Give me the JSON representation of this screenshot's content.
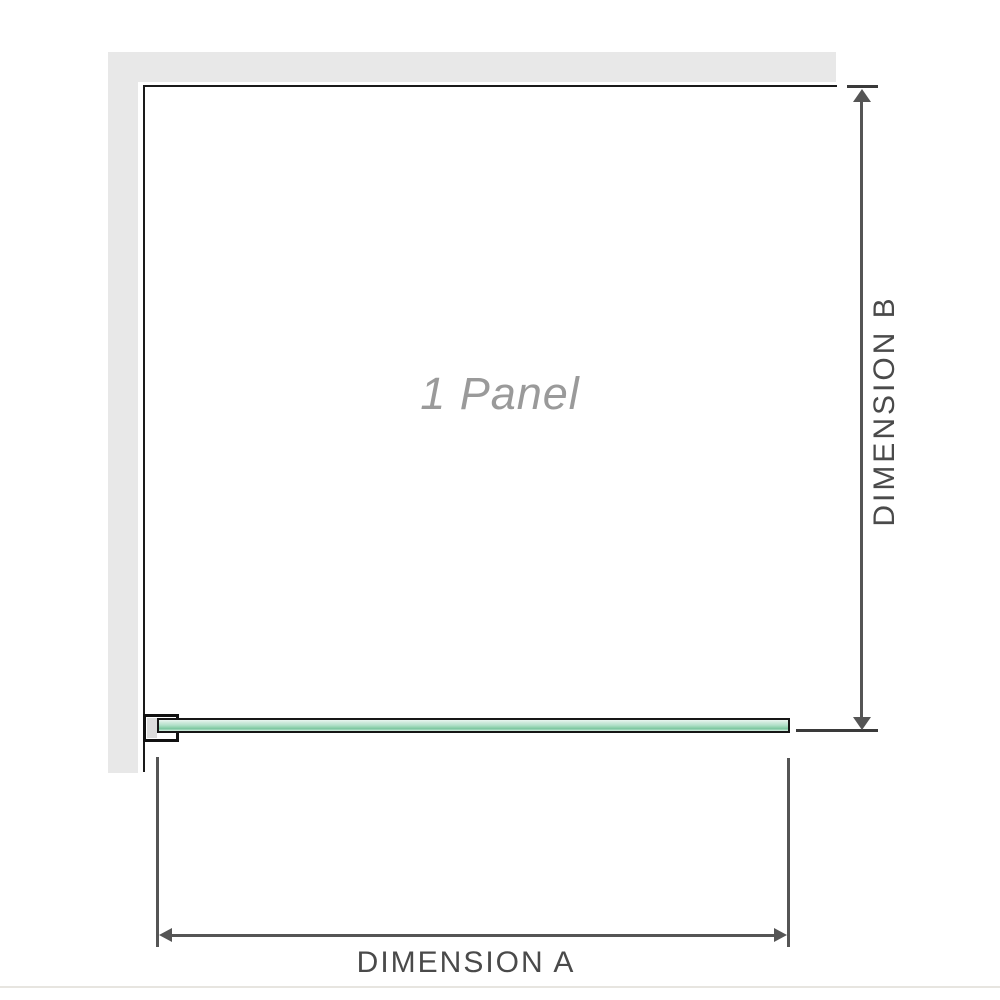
{
  "diagram": {
    "title": "1 Panel",
    "dimensions": {
      "a": {
        "label": "DIMENSION A"
      },
      "b": {
        "label": "DIMENSION B"
      }
    },
    "icons": {
      "dimension_a_arrow": "horizontal-double-arrow",
      "dimension_b_arrow": "vertical-double-arrow"
    },
    "colors": {
      "wall_gray": "#e8e8e8",
      "panel_edge_black": "#1a1a1a",
      "glass_green": "#aedfc6",
      "glass_green_dark": "#7cc6a0",
      "glass_green_light": "#eaf6f0",
      "dimension_line_gray": "#555555",
      "tick_gray": "#3a3a3a",
      "label_gray": "#4a4a4a",
      "panel_label_gray": "#9a9a9a",
      "baseline_gray": "#e7e5e0"
    }
  }
}
